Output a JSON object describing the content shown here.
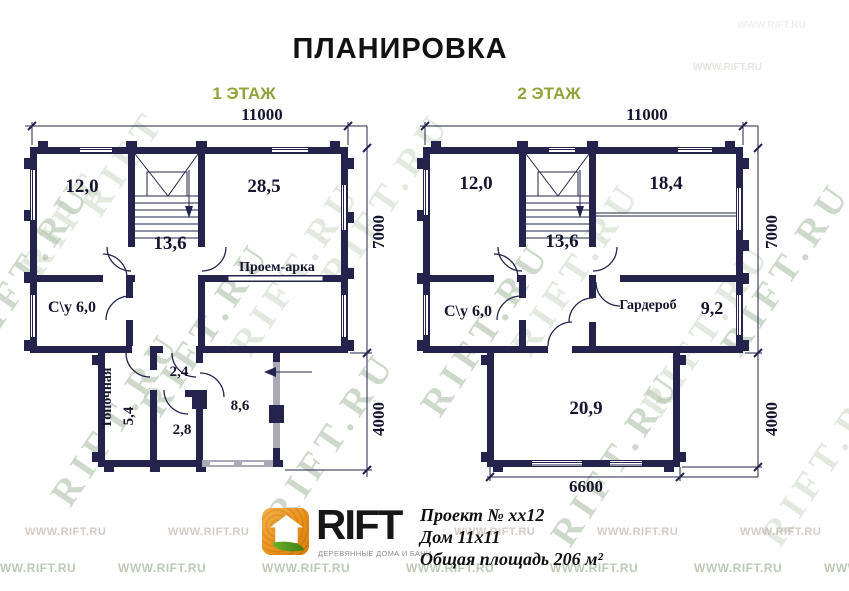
{
  "title": "ПЛАНИРОВКА",
  "floors": [
    {
      "label": "1 ЭТАЖ",
      "dims": {
        "width": "11000",
        "height": "7000",
        "annex_height": "4000"
      },
      "rooms": {
        "r120": "12,0",
        "r285": "28,5",
        "r136": "13,6",
        "su": "С\\у 6,0",
        "arch": "Проем-арка",
        "boiler": "Топочная",
        "b54": "5,4",
        "h24": "2,4",
        "h28": "2,8",
        "h86": "8,6"
      }
    },
    {
      "label": "2 ЭТАЖ",
      "dims": {
        "width": "11000",
        "height": "7000",
        "annex_height": "4000",
        "annex_width": "6600"
      },
      "rooms": {
        "r120": "12,0",
        "r184": "18,4",
        "r136": "13,6",
        "su": "С\\у 6,0",
        "wardrobe": "Гардероб",
        "w92": "9,2",
        "r209": "20,9"
      }
    }
  ],
  "footer": {
    "brand": "RIFT",
    "tagline": "ДЕРЕВЯННЫЕ ДОМА И БАНИ",
    "project": {
      "line1": "Проект № хх12",
      "line2": "Дом 11х11",
      "line3": "Общая площадь 206 м²"
    }
  },
  "watermarks": {
    "diagonal": "RIFT.RU",
    "short": "RIFT",
    "bottom": "WWW.RIFT.RU"
  },
  "colors": {
    "wall": "#23234e",
    "floor_label_green": "#94a23c",
    "logo_orange": "#e8921a",
    "leaf_green": "#4f9a1f",
    "watermark_green": "#a4ba9e"
  }
}
